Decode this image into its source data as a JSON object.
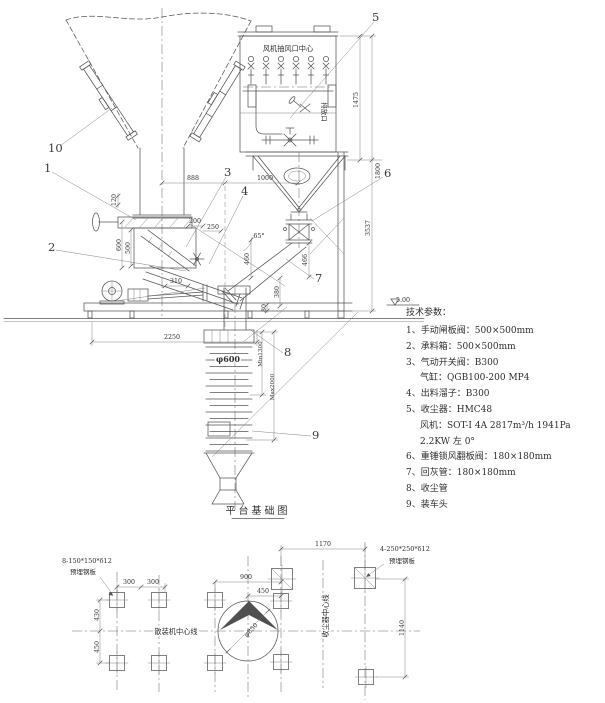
{
  "elevation": {
    "labels": {
      "fan_suction_center": "风机抽风口中心",
      "discharge_port": "排放口"
    },
    "callouts": {
      "c1": "1",
      "c2": "2",
      "c3": "3",
      "c4": "4",
      "c5": "5",
      "c6": "6",
      "c7": "7",
      "c8": "8",
      "c9": "9",
      "c10": "10"
    },
    "dims": {
      "w888": "888",
      "w1000": "1000",
      "h120": "120",
      "h600": "600",
      "h500": "500",
      "w310": "310",
      "w200": "200",
      "w250": "250",
      "a65": "65°",
      "h460": "460",
      "h466": "466",
      "h380": "380",
      "h80": "80",
      "w2250": "2250",
      "h1475": "1475",
      "h1800": "1800",
      "h3537": "3537",
      "dia600": "φ600",
      "min_h": "Min1300",
      "max_h": "Max2000",
      "level": "5.00"
    }
  },
  "tech_params": {
    "title": "技术参数：",
    "lines": [
      "1、手动闸板阀：500×500mm",
      "2、承料箱：500×500mm",
      "3、气动开关阀：B300",
      "气缸：QGB100-200 MP4",
      "4、出料溜子：B300",
      "5、收尘器：HMC48",
      "风机：SOT-Ⅰ 4A 2817m³/h 1941Pa",
      "2.2KW 左 0°",
      "6、重锤锁风翻板阀：180×180mm",
      "7、回灰管：180×180mm",
      "8、收尘管",
      "9、装车头"
    ]
  },
  "plan": {
    "title": "平台基础图",
    "labels": {
      "left_plate_spec": "8-150*150*δ12",
      "left_plate_name": "预埋钢板",
      "right_plate_spec": "4-250*250*δ12",
      "right_plate_name": "预埋钢板",
      "bulk_machine_centerline": "散装机中心线",
      "dust_collector_centerline": "收尘器中心线"
    },
    "dims": {
      "w300a": "300",
      "w300b": "300",
      "h430": "430",
      "h450": "450",
      "w900": "900",
      "w450": "450",
      "w1170": "1170",
      "h1140": "1140",
      "dia850": "φ850"
    }
  }
}
